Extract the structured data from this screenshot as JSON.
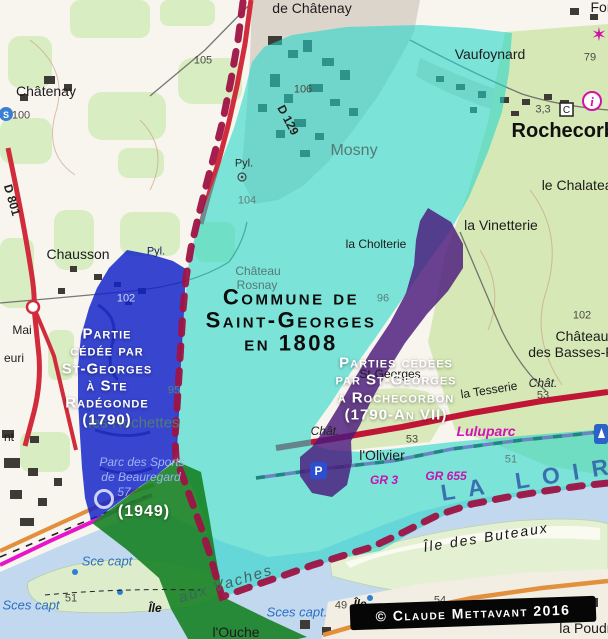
{
  "annotations": {
    "commune": "Commune de\nSaint-Georges\nen 1808",
    "left": "Partie\ncédée par\nSt-Georges\nà Ste\nRadégonde\n(1790)",
    "left_year": "(1949)",
    "right": "Parties cédées\npar St-Georges\nà Rochecorbon\n(1790-An VII)",
    "copyright": "© Claude Mettavant 2016"
  },
  "icons": {
    "parking": "P",
    "gite": "C",
    "info": "i",
    "spring": "S",
    "star": "✶"
  },
  "colors": {
    "cyan_overlay": "#22d6ca",
    "blue_overlay": "#1223c8",
    "purple_overlay": "#4b197d",
    "green_overlay": "#168223",
    "boundary": "#9e1345"
  },
  "map_labels": [
    {
      "t": "de Châtenay",
      "x": 312,
      "y": 8,
      "c": "place-lg"
    },
    {
      "t": "Châtenay",
      "x": 46,
      "y": 91,
      "c": "place-lg"
    },
    {
      "t": "105",
      "x": 203,
      "y": 61,
      "c": "num"
    },
    {
      "t": "100",
      "x": 21,
      "y": 116,
      "c": "num"
    },
    {
      "t": "106",
      "x": 303,
      "y": 90,
      "c": "num"
    },
    {
      "t": "D 129",
      "x": 288,
      "y": 120,
      "c": "road-label",
      "r": 62
    },
    {
      "t": "D 801",
      "x": 12,
      "y": 200,
      "c": "road-label",
      "r": 74
    },
    {
      "t": "Pyl.",
      "x": 244,
      "y": 164,
      "c": "hamlet-sm"
    },
    {
      "t": "104",
      "x": 247,
      "y": 201,
      "c": "under-num"
    },
    {
      "t": "Mosny",
      "x": 354,
      "y": 151,
      "c": "under",
      "s": 16
    },
    {
      "t": "Vaufoynard",
      "x": 490,
      "y": 54,
      "c": "place-lg"
    },
    {
      "t": "For",
      "x": 601,
      "y": 7,
      "c": "place-lg"
    },
    {
      "t": "79",
      "x": 590,
      "y": 58,
      "c": "num"
    },
    {
      "t": "3,3",
      "x": 543,
      "y": 110,
      "c": "num"
    },
    {
      "t": "Rochecorbon",
      "x": 576,
      "y": 131,
      "c": "town"
    },
    {
      "t": "le Chalateau",
      "x": 581,
      "y": 185,
      "c": "place-lg"
    },
    {
      "t": "la Vinetterie",
      "x": 501,
      "y": 225,
      "c": "place-lg"
    },
    {
      "t": "la Cholterie",
      "x": 376,
      "y": 244,
      "c": "place"
    },
    {
      "t": "Chausson",
      "x": 78,
      "y": 254,
      "c": "place-lg"
    },
    {
      "t": "Château",
      "x": 258,
      "y": 271,
      "c": "under"
    },
    {
      "t": "Rosnay",
      "x": 257,
      "y": 285,
      "c": "under"
    },
    {
      "t": "96",
      "x": 383,
      "y": 299,
      "c": "under-num"
    },
    {
      "t": "95",
      "x": 174,
      "y": 391,
      "c": "under-num"
    },
    {
      "t": "les Rochettes",
      "x": 134,
      "y": 423,
      "c": "under",
      "s": 15
    },
    {
      "t": "102",
      "x": 126,
      "y": 299,
      "c": "num-light"
    },
    {
      "t": "Pyl.",
      "x": 156,
      "y": 252,
      "c": "navy"
    },
    {
      "t": "Mai",
      "x": 22,
      "y": 330,
      "c": "place"
    },
    {
      "t": "euri",
      "x": 14,
      "y": 358,
      "c": "place"
    },
    {
      "t": "nt",
      "x": 9,
      "y": 437,
      "c": "place"
    },
    {
      "t": "St-Georges",
      "x": 390,
      "y": 374,
      "c": "place"
    },
    {
      "t": "la Tesserie",
      "x": 489,
      "y": 390,
      "c": "place",
      "r": -9
    },
    {
      "t": "Chât.",
      "x": 543,
      "y": 383,
      "c": "chateau-it"
    },
    {
      "t": "Château",
      "x": 582,
      "y": 336,
      "c": "place-lg"
    },
    {
      "t": "des Basses-Rivières",
      "x": 592,
      "y": 352,
      "c": "place-lg"
    },
    {
      "t": "102",
      "x": 582,
      "y": 316,
      "c": "num"
    },
    {
      "t": "53",
      "x": 543,
      "y": 396,
      "c": "num"
    },
    {
      "t": "53",
      "x": 412,
      "y": 440,
      "c": "num"
    },
    {
      "t": "Chât.",
      "x": 325,
      "y": 431,
      "c": "chateau-it"
    },
    {
      "t": "l'Olivier",
      "x": 382,
      "y": 455,
      "c": "place-lg"
    },
    {
      "t": "Luluparc",
      "x": 486,
      "y": 431,
      "c": "tourism"
    },
    {
      "t": "GR 3",
      "x": 384,
      "y": 480,
      "c": "gr"
    },
    {
      "t": "GR 655",
      "x": 446,
      "y": 476,
      "c": "gr"
    },
    {
      "t": "51",
      "x": 511,
      "y": 460,
      "c": "under-num"
    },
    {
      "t": "LA LOIRE",
      "x": 545,
      "y": 477,
      "c": "water-lg",
      "r": -9
    },
    {
      "t": "Île des Buteaux",
      "x": 486,
      "y": 537,
      "c": "island",
      "r": -9
    },
    {
      "t": "Île",
      "x": 360,
      "y": 604,
      "c": "island-sm"
    },
    {
      "t": "Île",
      "x": 155,
      "y": 608,
      "c": "island-sm"
    },
    {
      "t": "aux Vaches",
      "x": 226,
      "y": 584,
      "c": "under-it",
      "r": -17
    },
    {
      "t": "l'Ouche",
      "x": 236,
      "y": 632,
      "c": "place-lg"
    },
    {
      "t": "Sces capt",
      "x": 31,
      "y": 605,
      "c": "water"
    },
    {
      "t": "51",
      "x": 71,
      "y": 599,
      "c": "num"
    },
    {
      "t": "Sce capt",
      "x": 107,
      "y": 561,
      "c": "water"
    },
    {
      "t": "Sces capt.",
      "x": 297,
      "y": 612,
      "c": "water"
    },
    {
      "t": "49",
      "x": 341,
      "y": 606,
      "c": "num"
    },
    {
      "t": "54",
      "x": 440,
      "y": 601,
      "c": "num"
    },
    {
      "t": "la Poudrerie",
      "x": 597,
      "y": 628,
      "c": "place-lg"
    },
    {
      "t": "Parc des Sports",
      "x": 142,
      "y": 462,
      "c": "sports"
    },
    {
      "t": "de Beauregard",
      "x": 141,
      "y": 477,
      "c": "sports"
    },
    {
      "t": "57",
      "x": 124,
      "y": 492,
      "c": "sports"
    }
  ]
}
